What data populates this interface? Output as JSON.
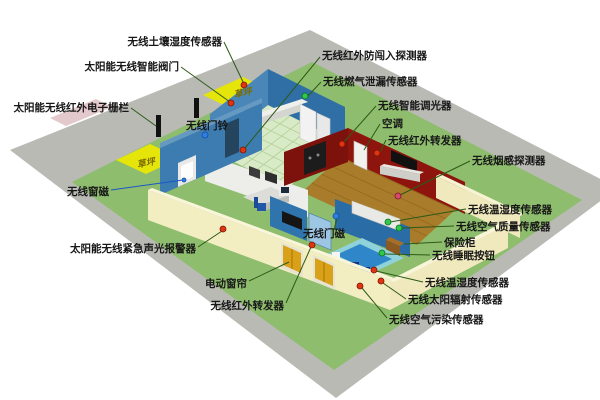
{
  "diagram": {
    "type": "isometric-smart-home-wireless-sensor-layout",
    "labels": {
      "soil_moisture": "无线土壤湿度传感器",
      "smart_valve": "太阳能无线智能阀门",
      "electronic_fence": "太阳能无线红外电子栅栏",
      "doorbell": "无线门铃",
      "window_magnet": "无线窗磁",
      "emergency_alarm": "太阳能无线紧急声光报警器",
      "electric_curtain": "电动窗帘",
      "ir_repeater_bottom": "无线红外转发器",
      "intrusion_detector": "无线红外防闯入探测器",
      "gas_leak_sensor": "无线燃气泄漏传感器",
      "smart_dimmer": "无线智能调光器",
      "air_conditioner": "空调",
      "ir_repeater_top": "无线红外转发器",
      "smoke_detector": "无线烟感探测器",
      "temp_humidity_indoor": "无线温湿度传感器",
      "air_quality_sensor": "无线空气质量传感器",
      "safe_box": "保险柜",
      "sleep_button": "无线睡眠按钮",
      "door_magnet": "无线门磁",
      "temp_humidity_outdoor": "无线温湿度传感器",
      "solar_radiation_sensor": "无线太阳辐射传感器",
      "air_pollution_sensor": "无线空气污染传感器",
      "lawn_back": "草坪",
      "lawn_front": "草坪"
    },
    "colors": {
      "road": "#b9bab4",
      "lawn": "#8ebd6d",
      "lawn_patch": "#e6e50a",
      "perimeter_wall": "#f3eec2",
      "house_blue_wall": "#3c7cb0",
      "bedroom_wall": "#2a6ca6",
      "red_wall": "#8e150e",
      "wood_floor": "#a87c2a",
      "tile_floor": "#d8eac6",
      "pool_water": "#2f86c8",
      "pool_deck": "#8fd2da",
      "curtain_gold": "#d9a118",
      "marker_red": "#e03510",
      "marker_green": "#2ec84a",
      "marker_blue": "#2f7fe0",
      "marker_pink": "#d24a6e",
      "leader_line": "#2d5a16"
    }
  }
}
